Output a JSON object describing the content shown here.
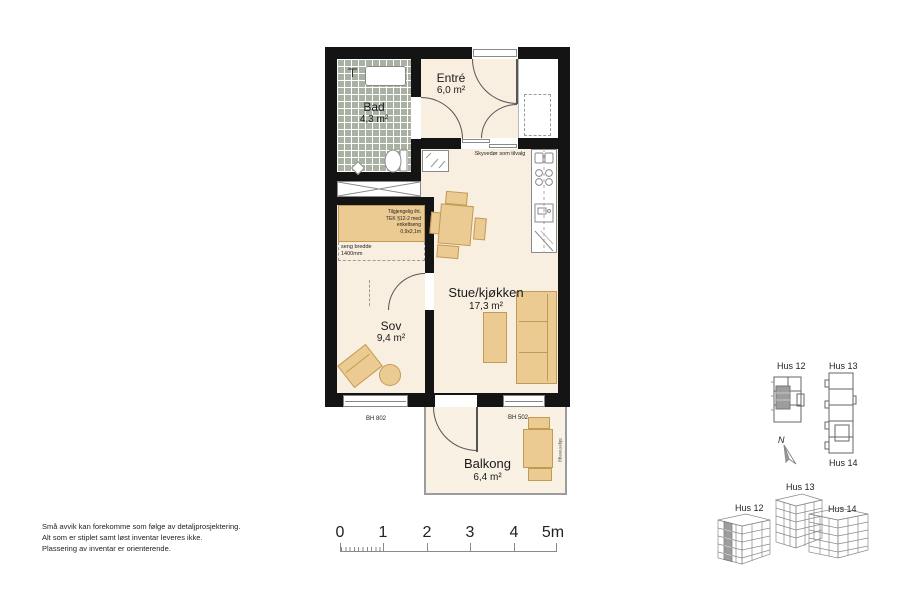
{
  "rooms": {
    "bad": {
      "name": "Bad",
      "area": "4,3 m²"
    },
    "entre": {
      "name": "Entré",
      "area": "6,0 m²"
    },
    "stue": {
      "name": "Stue/kjøkken",
      "area": "17,3 m²"
    },
    "sov": {
      "name": "Sov",
      "area": "9,4 m²"
    },
    "balkong": {
      "name": "Balkong",
      "area": "6,4 m²"
    }
  },
  "annotations": {
    "sliding_door": "Skyvedør som tilvalg",
    "bed_note": [
      "Tilgjengelig iht.",
      "TEK §12-2 med",
      "enkeltseng",
      "0,9x2,1m"
    ],
    "bed_width": [
      "seng bredde",
      "1400mm"
    ],
    "sill_left": "BH 802",
    "sill_right": "BH 502",
    "balcony_screen": "Skjermvegg",
    "fixture_t": "T"
  },
  "disclaimer": [
    "Små avvik kan forekomme som følge av detaljprosjektering.",
    "Alt som er stiplet samt løst inventar leveres ikke.",
    "Plassering av inventar er orienterende."
  ],
  "scale_bar": {
    "labels": [
      "0",
      "1",
      "2",
      "3",
      "4",
      "5m"
    ]
  },
  "site_plan": {
    "hus12": "Hus 12",
    "hus13": "Hus 13",
    "hus14": "Hus 14",
    "north": "N"
  },
  "axon_view": {
    "hus12": "Hus 12",
    "hus13": "Hus 13",
    "hus14": "Hus 14"
  },
  "colors": {
    "wall": "#141414",
    "floor": "#f8efe1",
    "furniture": "#eccb92",
    "furniture_border": "#c39a55",
    "bath_tile": "#a9b1a2",
    "unit_highlight": "#9d9d9d"
  }
}
